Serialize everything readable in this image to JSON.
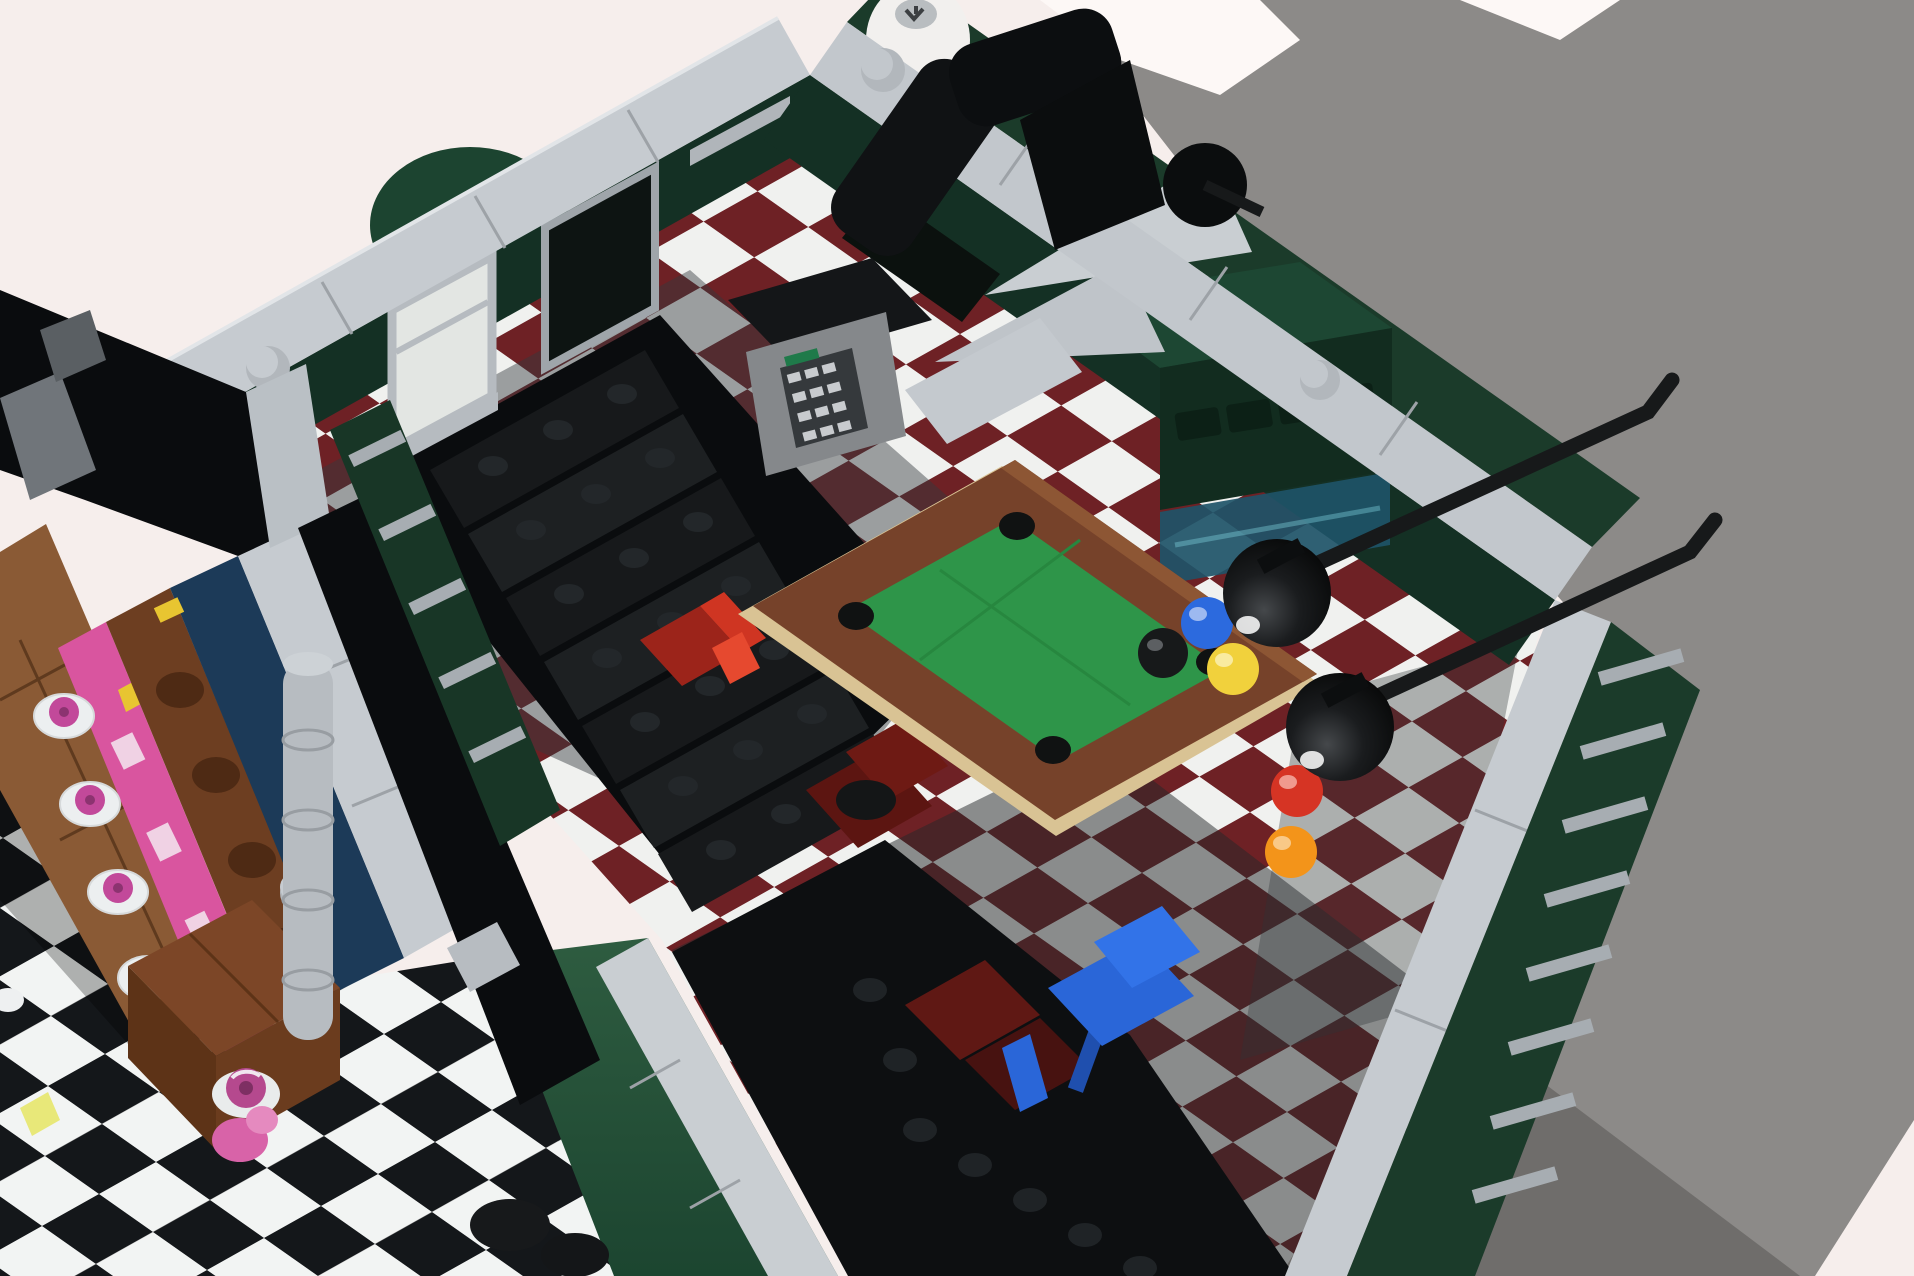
{
  "colors": {
    "backdrop_pink": "#f6eeec",
    "backdrop_gray": "#8c8a88",
    "backdrop_gray_dark": "#6f6d6b",
    "backdrop_white": "#fdf8f6",
    "coping_light": "#c6cbd0",
    "coping_light2": "#c2c7cc",
    "coping_seam": "#9da2a7",
    "stud_gray": "#b2b7bc",
    "wall_green_dark": "#143024",
    "wall_green_exterior": "#1b3b2a",
    "wall_green_lit": "#2e5c40",
    "wall_green_slatted": "#183626",
    "awning_green_dome": "#1c4430",
    "interior_black": "#0a0c0e",
    "void_black": "#0d0f11",
    "floor_tile_maroon": "#6e2125",
    "floor_tile_white": "#f0f1ef",
    "floor_shadow": "#333a3d",
    "bw_tile_black": "#14171a",
    "bw_tile_white": "#f2f4f3",
    "stair_black": "#17191b",
    "stair_black2": "#1d2022",
    "pool_felt": "#2e9549",
    "pool_rail_brown": "#76422a",
    "pool_rail_light": "#8d5634",
    "pool_base_tan": "#d9c394",
    "pocket_black": "#101212",
    "ball_blue": "#2c6ade",
    "ball_yellow": "#f1d13c",
    "ball_red": "#d63424",
    "ball_orange": "#f3941a",
    "ball_black": "#17191a",
    "lamp_black": "#141617",
    "lamp_pole": "#17191a",
    "chair_blue": "#2a66d8",
    "chair_red_bright": "#cf3522",
    "chair_red_dark": "#6e1a14",
    "sofa_red_deep": "#5f1814",
    "counter_green_top": "#1d4733",
    "counter_green_front": "#122c1f",
    "drawer_green": "#0c2016",
    "glass_teal": "#1e5468",
    "register_body": "#85888b",
    "register_top": "#141618",
    "keypad_dark": "#35393c",
    "keypad_key": "#c8cbce",
    "keypad_label_green": "#1f7a4a",
    "wood_floor_brown": "#8a5a35",
    "table_brown": "#7c4627",
    "counter_log_brown": "#6d3e21",
    "notch_brown": "#4e2a14",
    "display_pink": "#d9559f",
    "display_pink_dark": "#b74387",
    "navy_wall": "#1c3a58",
    "pillar_gray": "#b7bcc1",
    "plate_white": "#eceff0",
    "donut_pink": "#b5498e",
    "donut_hole": "#7e2f63",
    "minifig_pink": "#d863a8",
    "accent_yellow": "#e8c531",
    "pipe_black": "#101214",
    "cylinder_white": "#f2f0ee",
    "window_lit": "#e3e6e3",
    "window_dark": "#0d1412",
    "window_frame": "#b6bbc0",
    "slat_gray": "#a7adb2"
  },
  "scene": {
    "view": "isometric-top-down-render",
    "background": {
      "left_area": "pink-white-backdrop",
      "right_area": "gray-shadow-backdrop",
      "bottom_right_wedge": "pink-backdrop"
    },
    "billiard_room": {
      "floor": "maroon-white-checkerboard",
      "walls": "dark-green-with-light-gray-copings-and-studs",
      "stairwell": {
        "steps": 7,
        "color": "black",
        "studs_per_step": 3
      },
      "pool_table": {
        "rails": "brown",
        "base": "tan",
        "felt": "green",
        "pockets": 4,
        "balls": [
          {
            "name": "black-ball",
            "color": "#17191a"
          },
          {
            "name": "blue-ball",
            "color": "#2c6ade"
          },
          {
            "name": "yellow-ball",
            "color": "#f1d13c"
          },
          {
            "name": "red-ball",
            "color": "#d63424"
          },
          {
            "name": "orange-ball",
            "color": "#f3941a"
          }
        ],
        "hanging_lamps": {
          "count": 2,
          "shade": "black-dome",
          "pole": "black"
        }
      },
      "seating": {
        "blue_chair": "#2a66d8",
        "red_chair_bright": "#cf3522",
        "red_armchair_dark": "#6e1a14"
      },
      "bar_counter": {
        "body": "dark-green",
        "drawers": 4,
        "glass": "teal"
      },
      "cash_register": {
        "body": "gray",
        "keypad_keys": 12,
        "label": "green"
      },
      "windows": {
        "lit": 1,
        "dark": 2
      },
      "rooftop_props": [
        "green-dome",
        "white-cylinder",
        "black-pipes",
        "black-ball-joint"
      ]
    },
    "left_module": {
      "floor_upper": "brown-wood-planks",
      "floor_lower": "black-white-checkerboard",
      "walls": "navy-blue-with-light-gray-coping",
      "bakery_display": {
        "case": "pink",
        "counter": "log-brown",
        "plates": 5,
        "donuts": 3
      },
      "table": "brown-cube",
      "under_table": [
        "donut-on-plate",
        "pink-minifigure"
      ],
      "pillar": "light-gray-column",
      "small_props": [
        "yellow-piece",
        "white-cup"
      ]
    }
  }
}
